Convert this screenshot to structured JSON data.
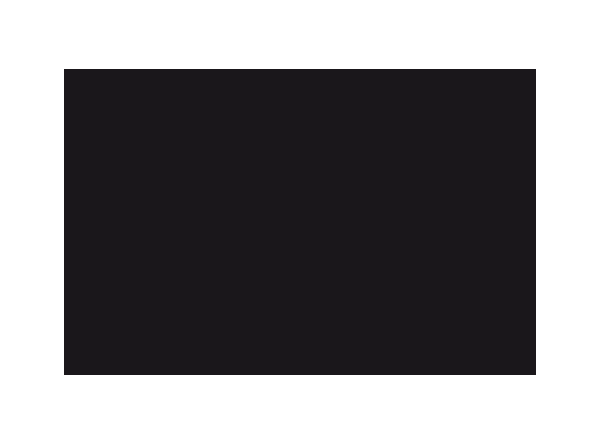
{
  "image": {
    "colors": {
      "page_background": "#ffffff",
      "rectangle_fill": "#1a171b"
    }
  }
}
